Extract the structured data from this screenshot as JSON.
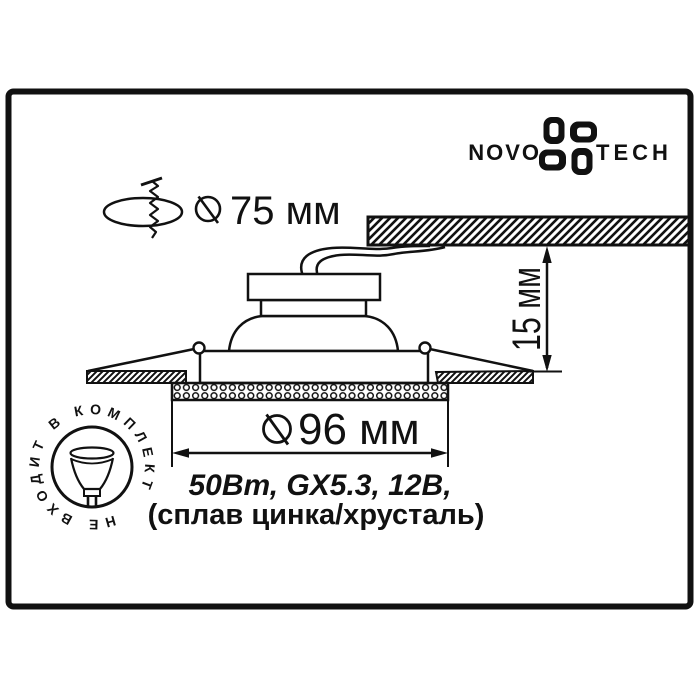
{
  "brand": {
    "novo": "NOVO",
    "tech": "TECH"
  },
  "labels": {
    "cutout_diameter": "75 мм",
    "depth": "15 мм",
    "diameter": "96 мм",
    "spec_line1": "50Вт, GX5.3, 12В,",
    "spec_line2": "(сплав цинка/хрусталь)",
    "stamp": "НЕ ВХОДИТ В КОМПЛЕКТ"
  },
  "colors": {
    "ink": "#111111",
    "background": "#ffffff"
  }
}
